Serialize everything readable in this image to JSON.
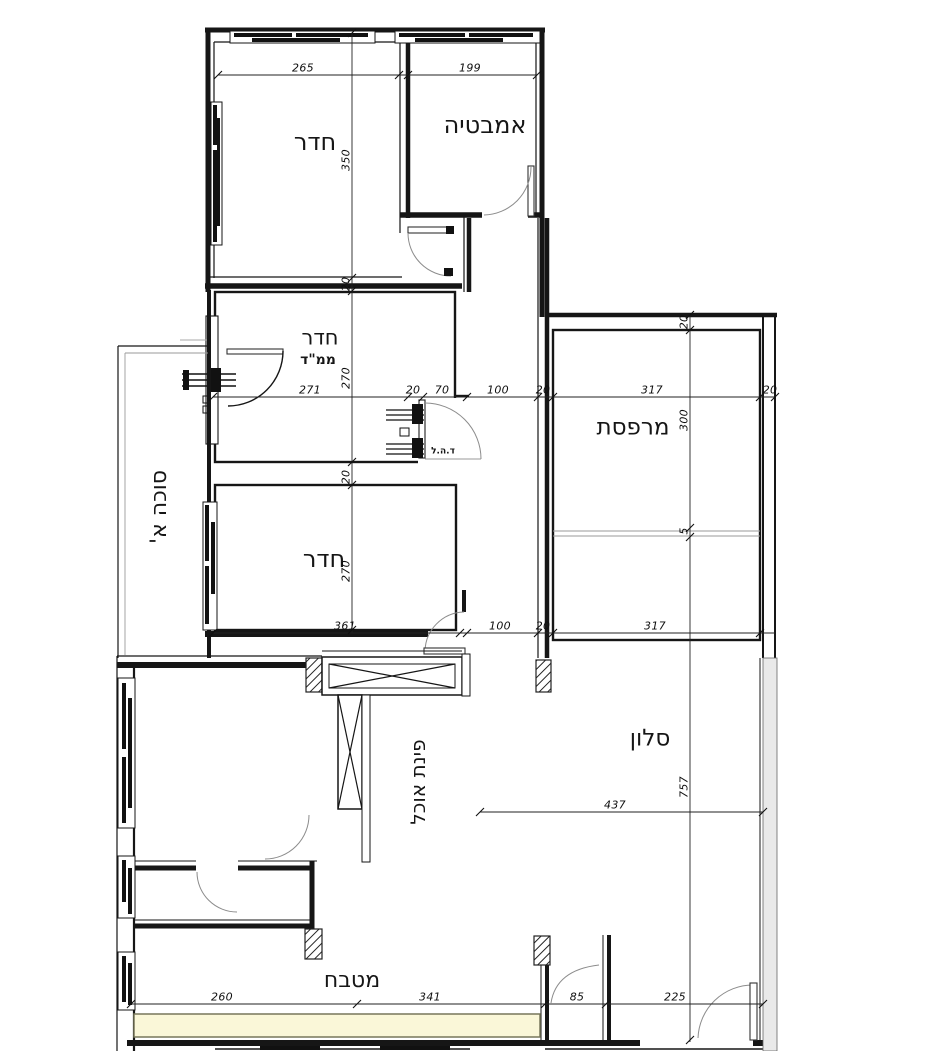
{
  "plan": {
    "type": "apartment-floor-plan",
    "rooms": [
      {
        "id": "bedroom-top",
        "label": "חדר",
        "x": 315,
        "y": 142,
        "s": 24,
        "r": 0,
        "b": false
      },
      {
        "id": "bathroom",
        "label": "אמבטיה",
        "x": 485,
        "y": 125,
        "s": 24,
        "r": 0,
        "b": false
      },
      {
        "id": "mamad-room",
        "label": "חדר",
        "x": 320,
        "y": 338,
        "s": 21,
        "r": 0,
        "b": false
      },
      {
        "id": "mamad-sub",
        "label": "ממ\"ד",
        "x": 318,
        "y": 360,
        "s": 14,
        "r": 0,
        "b": true
      },
      {
        "id": "balcony",
        "label": "מרפסת",
        "x": 633,
        "y": 428,
        "s": 23,
        "r": 0,
        "b": false
      },
      {
        "id": "sukkah",
        "label": "סוכה א'",
        "x": 160,
        "y": 507,
        "s": 22,
        "r": -90,
        "b": false
      },
      {
        "id": "bedroom-mid",
        "label": "חדר",
        "x": 324,
        "y": 559,
        "s": 24,
        "r": 0,
        "b": false
      },
      {
        "id": "dining",
        "label": "פינת אוכל",
        "x": 418,
        "y": 782,
        "s": 20,
        "r": -90,
        "b": false
      },
      {
        "id": "living",
        "label": "סלון",
        "x": 650,
        "y": 739,
        "s": 23,
        "r": 0,
        "b": false
      },
      {
        "id": "kitchen",
        "label": "מטבח",
        "x": 352,
        "y": 981,
        "s": 22,
        "r": 0,
        "b": false
      },
      {
        "id": "blast-door-note",
        "label": "ד.ה.ל",
        "x": 443,
        "y": 452,
        "s": 9,
        "r": 0,
        "b": true
      }
    ],
    "dimensions": [
      {
        "v": "265",
        "x": 303,
        "y": 68,
        "r": 0
      },
      {
        "v": "199",
        "x": 470,
        "y": 68,
        "r": 0
      },
      {
        "v": "350",
        "x": 346,
        "y": 160,
        "r": -90
      },
      {
        "v": "20",
        "x": 346,
        "y": 284,
        "r": -90
      },
      {
        "v": "271",
        "x": 310,
        "y": 390,
        "r": 0
      },
      {
        "v": "270",
        "x": 346,
        "y": 378,
        "r": -90
      },
      {
        "v": "20",
        "x": 413,
        "y": 390,
        "r": 0
      },
      {
        "v": "70",
        "x": 442,
        "y": 390,
        "r": 0
      },
      {
        "v": "100",
        "x": 498,
        "y": 390,
        "r": 0
      },
      {
        "v": "20",
        "x": 543,
        "y": 390,
        "r": 0
      },
      {
        "v": "317",
        "x": 652,
        "y": 390,
        "r": 0
      },
      {
        "v": "20",
        "x": 770,
        "y": 390,
        "r": 0
      },
      {
        "v": "20",
        "x": 684,
        "y": 322,
        "r": -90
      },
      {
        "v": "300",
        "x": 684,
        "y": 420,
        "r": -90
      },
      {
        "v": "5",
        "x": 684,
        "y": 531,
        "r": -90
      },
      {
        "v": "20",
        "x": 346,
        "y": 477,
        "r": -90
      },
      {
        "v": "270",
        "x": 346,
        "y": 571,
        "r": -90
      },
      {
        "v": "361",
        "x": 345,
        "y": 626,
        "r": 0
      },
      {
        "v": "100",
        "x": 500,
        "y": 626,
        "r": 0
      },
      {
        "v": "20",
        "x": 543,
        "y": 626,
        "r": 0
      },
      {
        "v": "317",
        "x": 655,
        "y": 626,
        "r": 0
      },
      {
        "v": "437",
        "x": 615,
        "y": 805,
        "r": 0
      },
      {
        "v": "757",
        "x": 684,
        "y": 787,
        "r": -90
      },
      {
        "v": "260",
        "x": 222,
        "y": 997,
        "r": 0
      },
      {
        "v": "341",
        "x": 430,
        "y": 997,
        "r": 0
      },
      {
        "v": "85",
        "x": 577,
        "y": 997,
        "r": 0
      },
      {
        "v": "225",
        "x": 675,
        "y": 997,
        "r": 0
      }
    ]
  },
  "colors": {
    "wall": "#161616",
    "dim_line": "#222222",
    "door_arc": "#8c8c8c",
    "counter_fill": "#faf7d8",
    "counter_border": "#77775a",
    "neighbor_wall_fill": "#e9e9e9"
  }
}
